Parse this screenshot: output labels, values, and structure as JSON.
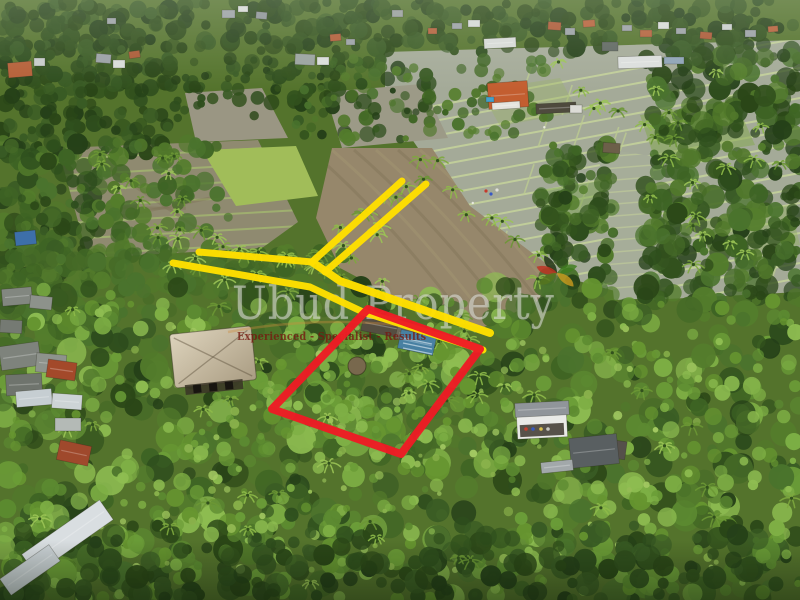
{
  "watermark": {
    "title": "Ubud Property",
    "tagline": "Experienced - Specialist - Results",
    "title_color": "rgba(232,234,228,0.52)",
    "tagline_color": "rgba(118,26,16,0.8)",
    "logo_colors": [
      "#1c2e10",
      "#c03222",
      "#3e7c1e",
      "#c89a1e",
      "#55751f"
    ]
  },
  "overlays": {
    "plot_boundary": {
      "color": "#ee1b24",
      "stroke_width": 8,
      "points": [
        [
          368,
          309
        ],
        [
          480,
          349
        ],
        [
          401,
          454
        ],
        [
          272,
          409
        ]
      ]
    },
    "road_marking": {
      "color": "#ffdf00",
      "lines": [
        {
          "points": [
            [
              402,
              181
            ],
            [
              312,
              262
            ]
          ],
          "width": 7
        },
        {
          "points": [
            [
              426,
              184
            ],
            [
              325,
              272
            ]
          ],
          "width": 7
        },
        {
          "points": [
            [
              199,
              252
            ],
            [
              312,
              262
            ]
          ],
          "width": 7
        },
        {
          "points": [
            [
              173,
              263
            ],
            [
              310,
              287
            ],
            [
              363,
              312
            ],
            [
              483,
              350
            ]
          ],
          "width": 7
        },
        {
          "points": [
            [
              312,
              262
            ],
            [
              340,
              281
            ],
            [
              490,
              333
            ]
          ],
          "width": 8
        }
      ]
    }
  },
  "scene": {
    "description": "Aerial drone photo of a jungle land plot beside rice paddies and village, with plot boundary and access road markings",
    "palette": {
      "paddy_water": "#a4aa99",
      "paddy_mud": "#95876c",
      "dike_green": "#c6d49d",
      "jungle_dark": "#2f4a1c",
      "jungle_bright": "#7fae49"
    }
  }
}
